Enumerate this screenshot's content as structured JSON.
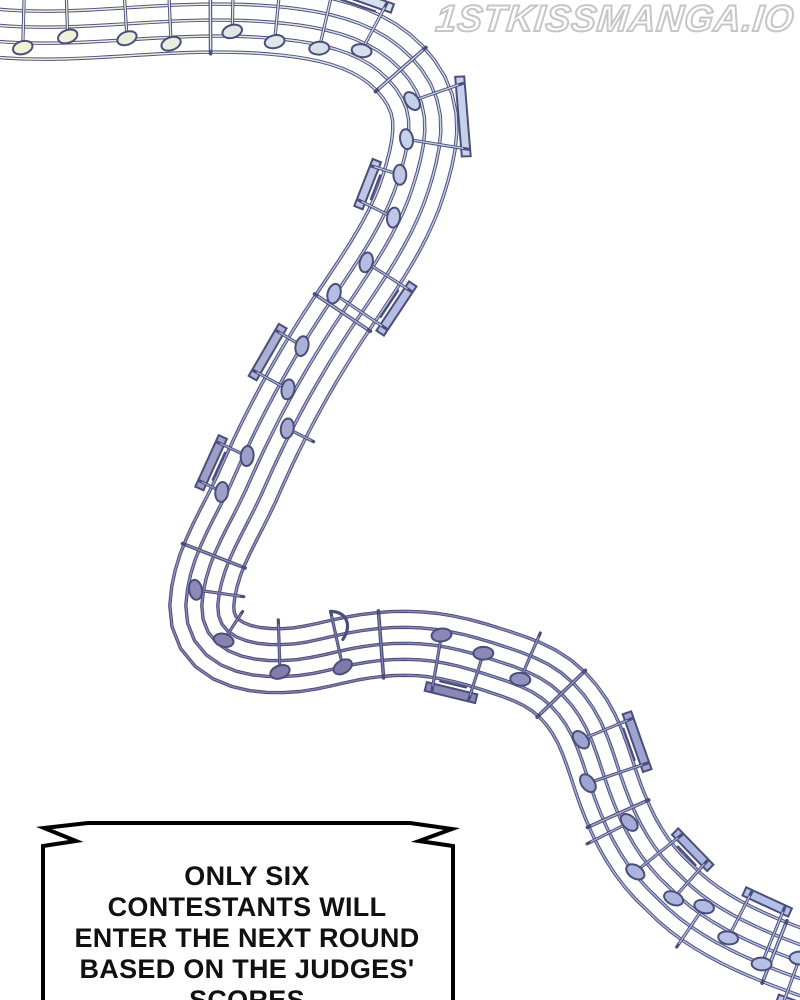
{
  "watermark": {
    "text": "1STKISSMANGA.IO",
    "outline_color": "#c6c6c6"
  },
  "bubble": {
    "shape": "flash-notched-rectangle",
    "fill_color": "#ffffff",
    "border_color": "#000000",
    "text_color": "#111111",
    "lines": [
      "ONLY SIX",
      "CONTESTANTS WILL",
      "ENTER THE NEXT ROUND",
      "BASED ON THE JUDGES'",
      "SCORES"
    ]
  },
  "artwork": {
    "description": "winding 5-line musical staff ribbon with beamed eighth notes, curving from top-left down to bottom-right",
    "background": "#ffffff",
    "outline_color": "#4b4e7a",
    "palette_stops": [
      [
        0.0,
        "#f2f2d9"
      ],
      [
        0.06,
        "#eeefdb"
      ],
      [
        0.12,
        "#e4ece6"
      ],
      [
        0.2,
        "#d3dfea"
      ],
      [
        0.28,
        "#c2cde8"
      ],
      [
        0.36,
        "#b4bce2"
      ],
      [
        0.46,
        "#a3a5cd"
      ],
      [
        0.56,
        "#8a84b2"
      ],
      [
        0.64,
        "#7f78a8"
      ],
      [
        0.72,
        "#8b8ab8"
      ],
      [
        0.8,
        "#9aa2cd"
      ],
      [
        0.9,
        "#aeb8e0"
      ],
      [
        1.0,
        "#bdc9ec"
      ]
    ]
  }
}
